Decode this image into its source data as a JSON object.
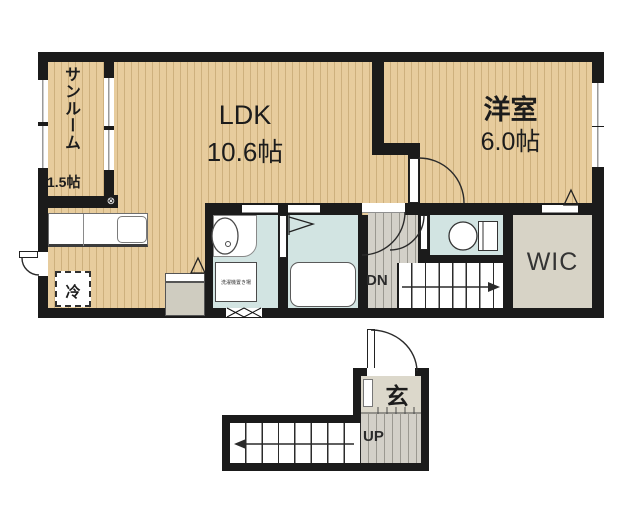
{
  "rooms": {
    "sunroom": {
      "name": "サンルーム",
      "size": "1.5帖"
    },
    "ldk": {
      "name": "LDK",
      "size": "10.6帖"
    },
    "western_room": {
      "name": "洋室",
      "size": "6.0帖"
    },
    "wic": {
      "name": "WIC"
    },
    "entrance": {
      "name": "玄"
    }
  },
  "fixtures": {
    "refrigerator_label": "冷",
    "laundry_space_label": "洗濯機置き場"
  },
  "stairs": {
    "down_label": "DN",
    "up_label": "UP"
  },
  "symbols": {
    "alarm_mark": "⊗"
  },
  "colors": {
    "wall": "#1b1b1b",
    "wood_floor": "#e7cc9d",
    "wet_area_floor": "#d2e4e2",
    "hall_floor": "#d3d0c8",
    "wic_floor": "#d7d3c6",
    "entrance_floor": "#dcd8cb"
  }
}
